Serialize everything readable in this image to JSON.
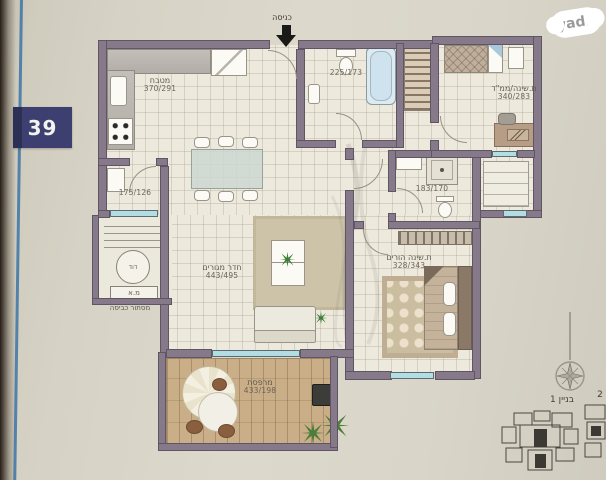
{
  "brand": {
    "logo_text": "yad2"
  },
  "sheet": {
    "apartment_number": "39",
    "building_label": "בניין 1",
    "building2_label": "2"
  },
  "entrance": {
    "label": "כניסה"
  },
  "rooms": {
    "kitchen": {
      "name": "מטבח",
      "dims": "370/291"
    },
    "service_balcony": {
      "dims": "175/126"
    },
    "living": {
      "name": "חדר מגורים",
      "dims": "443/495"
    },
    "bathroom": {
      "dims": "225/173"
    },
    "safe_bedroom": {
      "name": "ת.שינה/ממ\"ד",
      "dims": "340/283"
    },
    "shower_room": {
      "dims": "183/170"
    },
    "master_bedroom": {
      "name": "ת.שינה הורים",
      "dims": "328/343"
    },
    "balcony": {
      "name": "מרפסת",
      "dims": "433/198"
    }
  },
  "utility": {
    "boiler": "דוד",
    "ac": "מ.א",
    "caption": "מסתור כביסה"
  },
  "colors": {
    "wall": "#85798a",
    "window": "#b2dde2",
    "badge": "#3c3f70",
    "fold_line": "#3c74a6",
    "deck": "#c9ae87",
    "paper": "#d8d4c8"
  }
}
